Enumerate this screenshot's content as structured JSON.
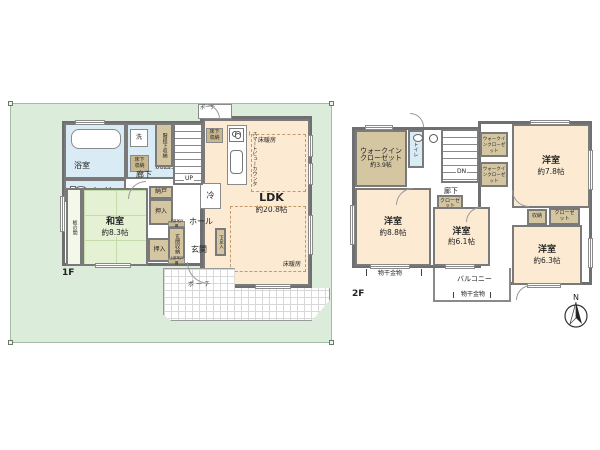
{
  "floor1": {
    "label": "1F",
    "rooms": {
      "bath": "浴室",
      "washer": "洗",
      "washroom": "洗面室",
      "underfloor_storage": "床下収納",
      "toilet": "トイレ",
      "stair_storage": "階段下収納",
      "up": "UP",
      "corridor": "廊下",
      "storeroom": "納戸",
      "oshiire": "押入",
      "itanoma": "板の間",
      "washitsu_name": "和室",
      "washitsu_size": "約8.3帖",
      "entrance_storage": "玄関収納",
      "upper_cabinet": "上部吊戸棚",
      "entrance": "玄関",
      "hall": "ホール",
      "shoe_box": "下足入",
      "fridge": "冷",
      "counter": "スマートビューカウンター",
      "floor_heating": "床暖房",
      "ldk_name": "LDK",
      "ldk_size": "約20.8帖",
      "porch": "ポーチ"
    }
  },
  "floor2": {
    "label": "2F",
    "rooms": {
      "wic_name1": "ウォークイン",
      "wic_name2": "クローゼット",
      "wic_size": "約3.9帖",
      "wic_small": "ウォークインクローゼット",
      "toilet": "トイレ",
      "dn": "DN",
      "corridor": "廊下",
      "closet": "クローゼット",
      "storage": "収納",
      "western_room": "洋室",
      "room78_size": "約7.8帖",
      "room88_size": "約8.8帖",
      "room61_size": "約6.1帖",
      "room63_size": "約6.3帖",
      "balcony": "バルコニー",
      "drying": "物干金物"
    }
  },
  "compass": {
    "north": "N"
  },
  "colors": {
    "site_green": "#dcecdb",
    "room_cream": "#fcebd2",
    "wet_blue": "#d9ebf4",
    "closet_tan": "#d5c6a2",
    "tatami_green": "#e4f1d3",
    "wall_gray": "#7a7a7a"
  }
}
